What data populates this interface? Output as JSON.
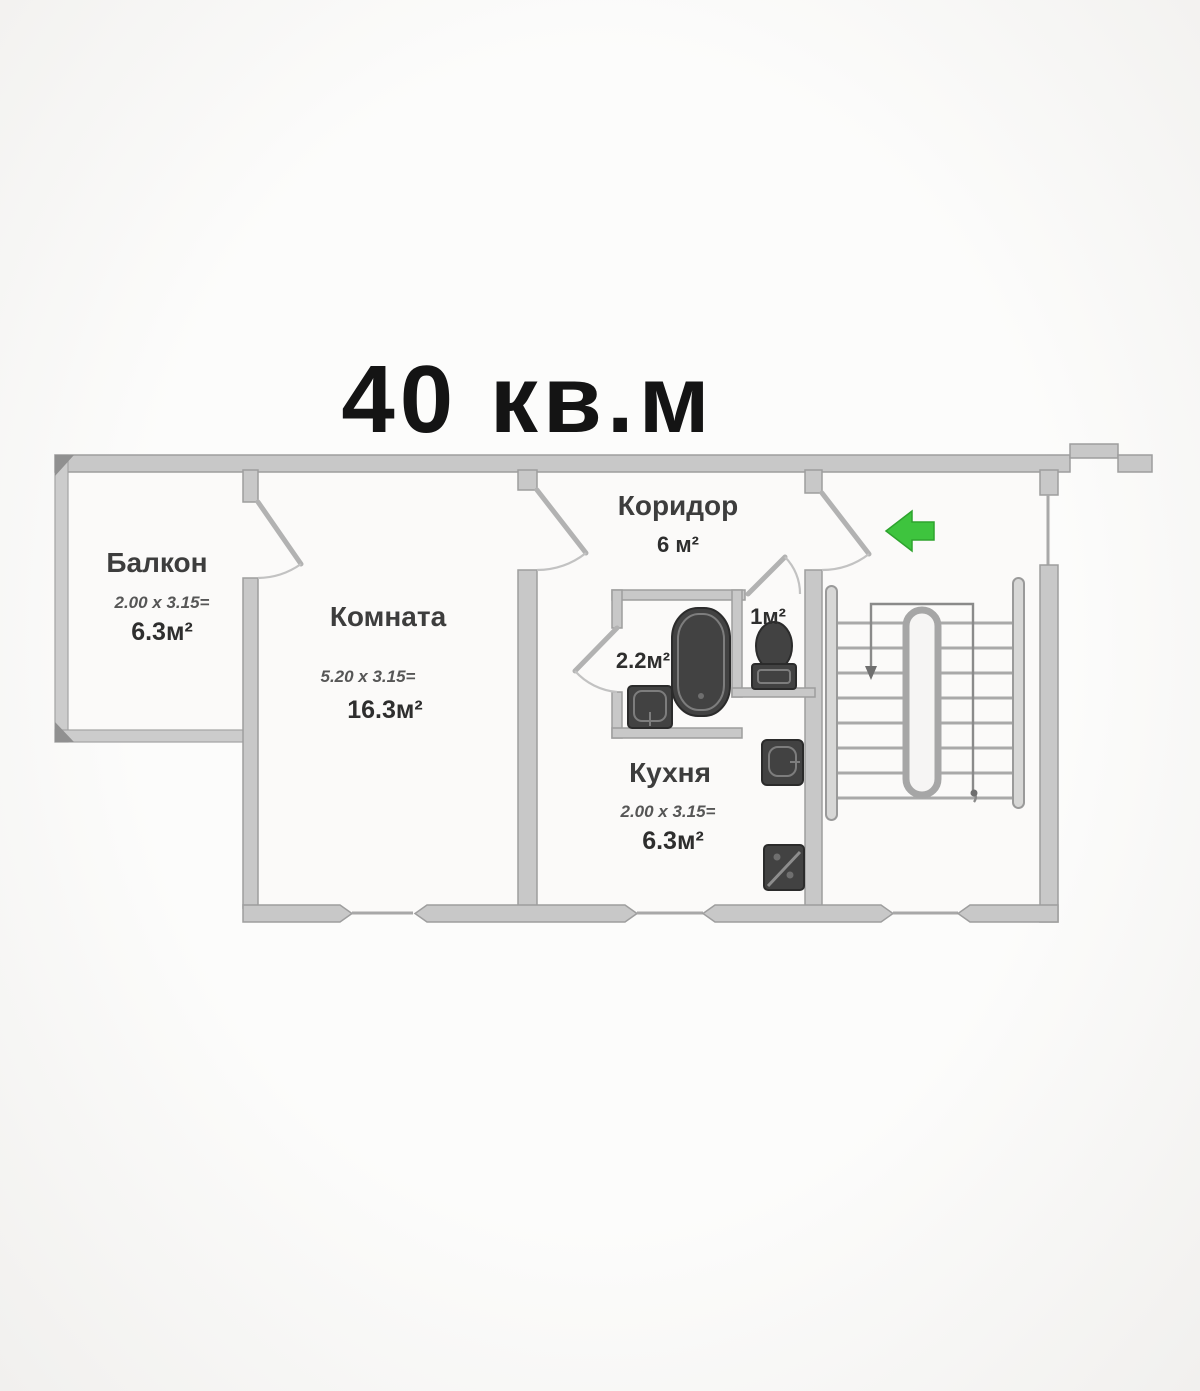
{
  "title": "40 кв.м",
  "rooms": {
    "balcony": {
      "name": "Балкон",
      "dims": "2.00 x 3.15=",
      "area": "6.3м²"
    },
    "living_room": {
      "name": "Комната",
      "dims": "5.20 x 3.15=",
      "area": "16.3м²"
    },
    "corridor": {
      "name": "Коридор",
      "area": "6 м²"
    },
    "bathroom": {
      "area": "2.2м²"
    },
    "toilet": {
      "area": "1м²"
    },
    "kitchen": {
      "name": "Кухня",
      "dims": "2.00 x 3.15=",
      "area": "6.3м²"
    }
  },
  "icons": {
    "entrance_arrow": "left-arrow"
  },
  "colors": {
    "wall": "#c8c8c8",
    "wall_edge": "#9e9e9e",
    "fixture_dark": "#424242",
    "entrance_arrow_green": "#3ec43e",
    "text": "#3a3a3a",
    "background": "#f6f5f3"
  }
}
